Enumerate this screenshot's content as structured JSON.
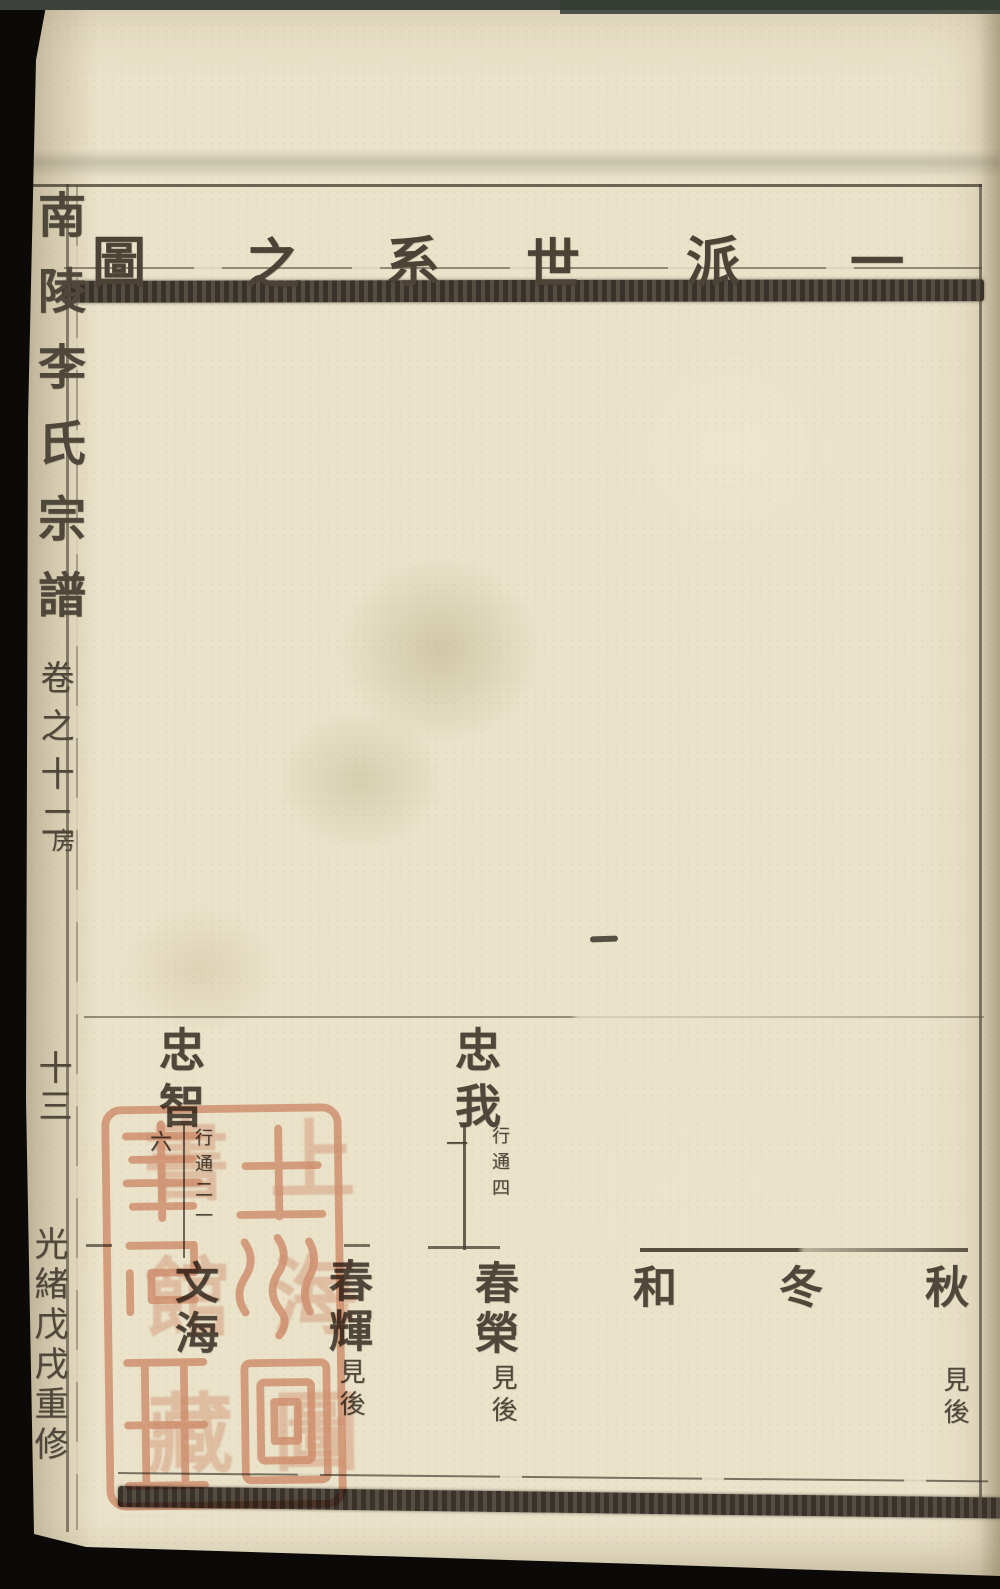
{
  "page": {
    "header": {
      "title": "一派世系之圖",
      "chars": [
        "一",
        "派",
        "世",
        "系",
        "之",
        "圖"
      ]
    },
    "spine": {
      "title": "南陵李氏宗譜",
      "volume": "卷之十二",
      "branch": "房",
      "page_number": "十三",
      "edition": "光緒戊戌重修"
    },
    "tree": {
      "generation1": [
        {
          "name": "忠智",
          "order": "六",
          "rank": "行通二一"
        },
        {
          "name": "忠我",
          "order": "一",
          "rank": "行通四"
        }
      ],
      "generation2": [
        {
          "name": "文海",
          "note": ""
        },
        {
          "name": "春輝",
          "note": "見後"
        },
        {
          "name": "春榮",
          "note": "見後"
        },
        {
          "name": "和",
          "note": ""
        },
        {
          "name": "冬",
          "note": ""
        },
        {
          "name": "秋",
          "note": "見後"
        }
      ]
    },
    "stray_mark": "一",
    "seal": {
      "text": "上海圖書館藏",
      "chars": [
        "上",
        "海",
        "圖",
        "書",
        "館",
        "藏"
      ],
      "color": "#de957c"
    },
    "colors": {
      "paper": "#eae2c9",
      "ink": "#4f473a",
      "seal_red": "#de957c",
      "background": "#0b0a08"
    }
  }
}
